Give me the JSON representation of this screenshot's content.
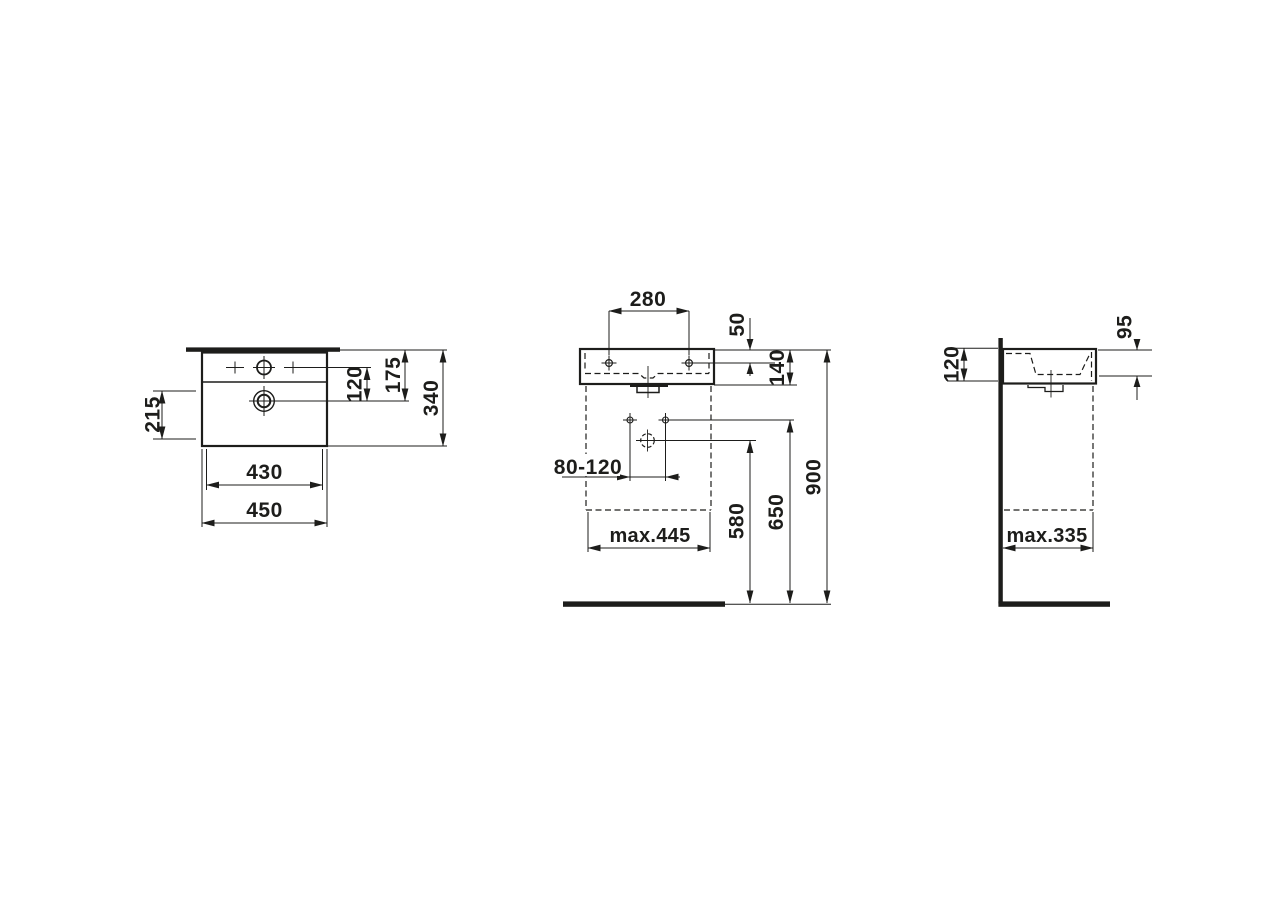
{
  "meta": {
    "background_color": "#ffffff",
    "line_color": "#1d1d1b",
    "drawing_type": "washbasin dimensional drawing, three views"
  },
  "views": {
    "top": {
      "overall_width": "450",
      "bowl_width": "430",
      "left_offset": "215",
      "tap_to_drain": "120",
      "back_to_drain": "175",
      "overall_depth": "340"
    },
    "front": {
      "fixing_hole_spacing": "280",
      "rim_to_fixing_hole": "50",
      "rim_to_bottom": "140",
      "supply_spacing": "80-120",
      "max_width_below": "max.445",
      "floor_to_waste": "580",
      "floor_to_supply": "650",
      "floor_to_rim": "900"
    },
    "side": {
      "bowl_depth": "95",
      "body_height": "120",
      "max_depth_below": "max.335"
    }
  }
}
